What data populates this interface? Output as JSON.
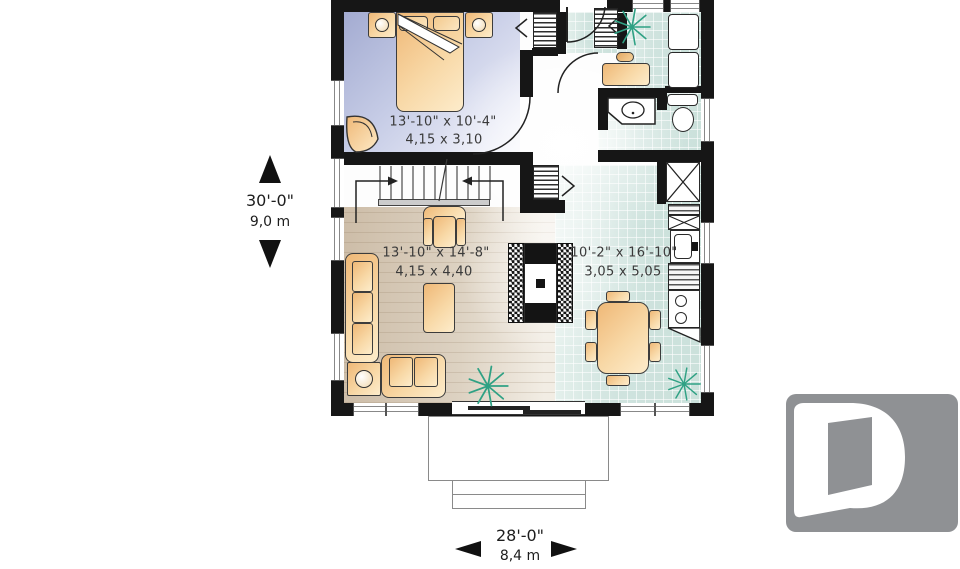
{
  "rooms": {
    "bedroom": {
      "imperial": "13'-10\" x 10'-4\"",
      "metric": "4,15 x 3,10"
    },
    "living": {
      "imperial": "13'-10\" x 14'-8\"",
      "metric": "4,15 x 4,40"
    },
    "kitchen_dining": {
      "imperial": "10'-2\" x 16'-10\"",
      "metric": "3,05 x 5,05"
    }
  },
  "overall_dimensions": {
    "depth": {
      "imperial": "30'-0\"",
      "metric": "9,0 m"
    },
    "width": {
      "imperial": "28'-0\"",
      "metric": "8,4 m"
    }
  },
  "logo": {
    "letter": "D"
  },
  "icons": {
    "plant": "starburst-lines",
    "fireplace": "checker-hatch-box",
    "stair_direction": "arrow-lines",
    "closet": "comb-hatch",
    "storage": "x-box"
  },
  "colors": {
    "wall": "#161616",
    "bedroom_floor": "#b3b9dc",
    "wood_floor": "#d9cab7",
    "tile_floor": "#cfe3de",
    "furniture": "#f5c88b",
    "plant": "#2fa184",
    "logo_bg": "#8f9194",
    "text": "#3a3a3a"
  }
}
